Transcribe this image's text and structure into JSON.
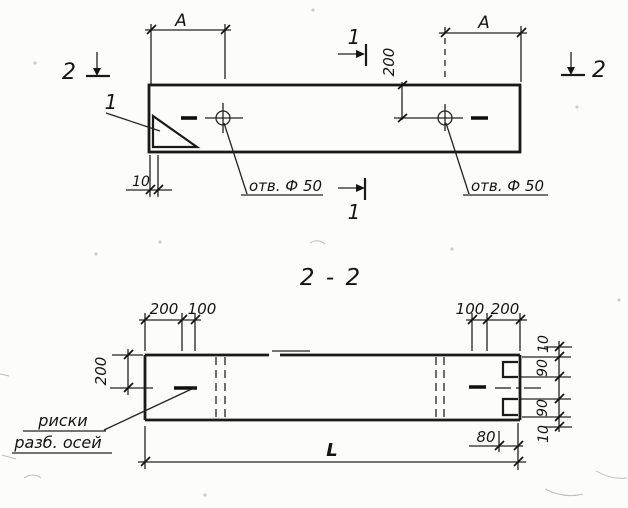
{
  "plan_view": {
    "dim_a_left": "A",
    "dim_a_right": "A",
    "dim_200": "200",
    "dim_10": "10",
    "hole_label_left": "отв. Ф 50",
    "hole_label_right": "отв. Ф 50",
    "detail_callout": "1",
    "section_marker_1_top": "1",
    "section_marker_1_bottom": "1",
    "section_marker_2_left": "2",
    "section_marker_2_right": "2"
  },
  "section_view": {
    "title": "2 - 2",
    "dim_left_200": "200",
    "dim_left_100": "100",
    "dim_right_100": "100",
    "dim_right_200": "200",
    "dim_height_200": "200",
    "dim_chain": [
      "10",
      "90",
      "90",
      "10"
    ],
    "dim_80": "80",
    "dim_length": "L",
    "axis_note_line1": "риски",
    "axis_note_line2": "разб. осей"
  },
  "colors": {
    "ink": "#1a1a1a",
    "paper": "#fcfcfa"
  }
}
